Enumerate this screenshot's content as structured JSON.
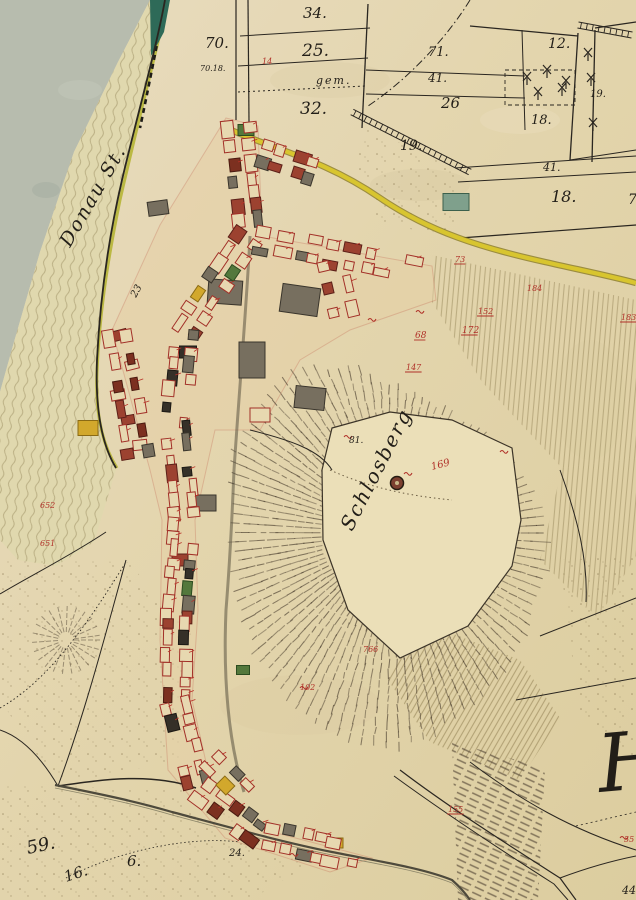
{
  "meta": {
    "map_type": "historical cadastral map",
    "sheet_letter": "H"
  },
  "palette": {
    "paper": "#e3d5ad",
    "paper_light": "#eaddc0",
    "paper_dark": "#d8c99e",
    "water": "#b7bcae",
    "flow_line": "#b3a77c",
    "shore": "#b6b536",
    "teal_bank": "#2e6a58",
    "road_yellow": "#d8c52f",
    "road_edge": "#8a7a26",
    "ink": "#2a2620",
    "carmine": "#a83028",
    "red_label": "#b03028",
    "hachure": "#44382a",
    "stone": "#776f5f",
    "stripe": "#b2a276",
    "village_tint": "#e5d0a6"
  },
  "labels": {
    "black": [
      {
        "t": "70.",
        "x": 205,
        "y": 48,
        "s": 15
      },
      {
        "t": "70.18.",
        "x": 200,
        "y": 71,
        "s": 8
      },
      {
        "t": "34.",
        "x": 303,
        "y": 18,
        "s": 15
      },
      {
        "t": "25.",
        "x": 302,
        "y": 56,
        "s": 17
      },
      {
        "t": "32.",
        "x": 300,
        "y": 114,
        "s": 17
      },
      {
        "t": "71.",
        "x": 428,
        "y": 56,
        "s": 13
      },
      {
        "t": "41.",
        "x": 428,
        "y": 82,
        "s": 12
      },
      {
        "t": "26",
        "x": 441,
        "y": 108,
        "s": 15
      },
      {
        "t": "12.",
        "x": 548,
        "y": 48,
        "s": 14
      },
      {
        "t": "19.",
        "x": 590,
        "y": 97,
        "s": 10
      },
      {
        "t": "18.",
        "x": 531,
        "y": 124,
        "s": 13
      },
      {
        "t": "41.",
        "x": 543,
        "y": 171,
        "s": 11
      },
      {
        "t": "18.",
        "x": 551,
        "y": 202,
        "s": 16
      },
      {
        "t": "70",
        "x": 628,
        "y": 204,
        "s": 14
      },
      {
        "t": "19.",
        "x": 400,
        "y": 150,
        "s": 14
      },
      {
        "t": "23",
        "x": 136,
        "y": 298,
        "s": 10,
        "r": -62
      },
      {
        "t": "81.",
        "x": 349,
        "y": 443,
        "s": 9
      },
      {
        "t": "24.",
        "x": 229,
        "y": 856,
        "s": 10
      },
      {
        "t": "59.",
        "x": 28,
        "y": 854,
        "s": 18,
        "r": -12
      },
      {
        "t": "16.",
        "x": 66,
        "y": 882,
        "s": 15,
        "r": -18
      },
      {
        "t": "6.",
        "x": 127,
        "y": 866,
        "s": 15
      },
      {
        "t": "44.",
        "x": 622,
        "y": 894,
        "s": 11
      }
    ],
    "script": [
      {
        "t": "gem.",
        "x": 316,
        "y": 84,
        "s": 11
      },
      {
        "t": "Donau St.",
        "x": 70,
        "y": 248,
        "s": 19,
        "r": -60
      },
      {
        "t": "Schlosberg",
        "x": 352,
        "y": 532,
        "s": 20,
        "r": -63
      },
      {
        "t": "H",
        "x": 600,
        "y": 792,
        "s": 80,
        "r": -5
      }
    ],
    "red": [
      {
        "t": "169",
        "x": 432,
        "y": 470,
        "s": 10,
        "r": -15
      },
      {
        "t": "68",
        "x": 415,
        "y": 338,
        "s": 9,
        "u": 1
      },
      {
        "t": "172",
        "x": 462,
        "y": 333,
        "s": 9,
        "u": 1
      },
      {
        "t": "147",
        "x": 406,
        "y": 370,
        "s": 8,
        "u": 1
      },
      {
        "t": "73",
        "x": 455,
        "y": 262,
        "s": 8,
        "u": 1
      },
      {
        "t": "152",
        "x": 478,
        "y": 314,
        "s": 8,
        "u": 1
      },
      {
        "t": "184",
        "x": 527,
        "y": 291,
        "s": 8
      },
      {
        "t": "183",
        "x": 621,
        "y": 320,
        "s": 8,
        "u": 1
      },
      {
        "t": "652",
        "x": 40,
        "y": 508,
        "s": 8
      },
      {
        "t": "651",
        "x": 40,
        "y": 546,
        "s": 8
      },
      {
        "t": "155",
        "x": 448,
        "y": 812,
        "s": 8,
        "u": 1
      },
      {
        "t": "766",
        "x": 363,
        "y": 652,
        "s": 8
      },
      {
        "t": "55",
        "x": 624,
        "y": 842,
        "s": 8
      },
      {
        "t": "102",
        "x": 300,
        "y": 690,
        "s": 8
      },
      {
        "t": "14",
        "x": 262,
        "y": 64,
        "s": 8
      }
    ]
  },
  "trees": [
    [
      527,
      77
    ],
    [
      547,
      70
    ],
    [
      566,
      81
    ],
    [
      538,
      92
    ],
    [
      562,
      88
    ],
    [
      588,
      53
    ],
    [
      591,
      78
    ],
    [
      593,
      123
    ]
  ],
  "geo": {
    "water": [
      [
        0,
        0
      ],
      [
        150,
        0
      ],
      [
        118,
        62
      ],
      [
        74,
        152
      ],
      [
        40,
        252
      ],
      [
        14,
        342
      ],
      [
        0,
        392
      ]
    ],
    "band": [
      [
        150,
        0
      ],
      [
        170,
        0
      ],
      [
        146,
        82
      ],
      [
        124,
        172
      ],
      [
        106,
        262
      ],
      [
        98,
        352
      ],
      [
        100,
        432
      ],
      [
        116,
        470
      ],
      [
        94,
        542
      ],
      [
        56,
        566
      ],
      [
        18,
        560
      ],
      [
        0,
        540
      ],
      [
        0,
        392
      ],
      [
        14,
        342
      ],
      [
        40,
        252
      ],
      [
        74,
        152
      ],
      [
        118,
        62
      ]
    ],
    "teal": [
      [
        150,
        0
      ],
      [
        170,
        0
      ],
      [
        164,
        32
      ],
      [
        151,
        56
      ]
    ],
    "shore": "M168,0 C156,52 136,130 120,200 C106,268 99,320 97,372 C95,415 103,446 117,468",
    "bank_ticks": "M165,2 C158,40 148,90 140,128",
    "village_tint": "M226,118 L258,126 L262,236 L432,266 L436,300 L350,330 L300,360 L260,430 L215,430 L195,520 L198,610 L192,700 L210,780 L265,830 L372,858 L330,872 L225,838 L168,770 L160,640 L162,520 L150,470 L112,330 L160,225 Z",
    "plateau": "M332,428 L390,412 L452,420 L512,448 L521,520 L512,566 L468,626 L400,658 L348,610 L323,540 L322,470 Z",
    "plateau_rows": "M330,470 C370,488 410,496 452,500",
    "hill": {
      "cx": 393,
      "cy": 533,
      "min": 70,
      "max": [
        152,
        160,
        185,
        215,
        200,
        172,
        158,
        182,
        192,
        150,
        128,
        142
      ]
    },
    "knob": {
      "cx": 66,
      "cy": 640,
      "rmin": 8,
      "rmax": 32
    },
    "hach_bands": [
      [
        [
          452,
          742
        ],
        [
          545,
          768
        ],
        [
          538,
          900
        ],
        [
          458,
          900
        ]
      ]
    ],
    "stripesA": [
      [
        [
          432,
          255
        ],
        [
          636,
          300
        ],
        [
          636,
          458
        ],
        [
          562,
          468
        ],
        [
          482,
          382
        ],
        [
          432,
          302
        ]
      ],
      [
        [
          562,
          468
        ],
        [
          636,
          458
        ],
        [
          636,
          556
        ],
        [
          598,
          618
        ],
        [
          540,
          560
        ]
      ]
    ],
    "stripesB": [
      [
        [
          418,
          620
        ],
        [
          520,
          660
        ],
        [
          560,
          718
        ],
        [
          520,
          780
        ],
        [
          430,
          742
        ],
        [
          388,
          680
        ]
      ]
    ],
    "stipple": [
      [
        [
          0,
          560
        ],
        [
          128,
          562
        ],
        [
          196,
          640
        ],
        [
          178,
          760
        ],
        [
          58,
          786
        ],
        [
          0,
          700
        ]
      ],
      [
        [
          0,
          786
        ],
        [
          58,
          786
        ],
        [
          196,
          790
        ],
        [
          320,
          858
        ],
        [
          250,
          900
        ],
        [
          0,
          900
        ]
      ],
      [
        [
          368,
          128
        ],
        [
          460,
          170
        ],
        [
          455,
          235
        ],
        [
          380,
          225
        ],
        [
          352,
          160
        ]
      ],
      [
        [
          560,
          560
        ],
        [
          636,
          556
        ],
        [
          636,
          760
        ],
        [
          580,
          720
        ]
      ]
    ],
    "road_main": "M222,126 C268,148 322,158 380,198 C430,232 482,248 545,262 C580,270 610,276 636,283",
    "stream": "M55,785 C95,793 135,801 172,812 C232,828 282,842 332,852 C382,862 422,868 452,880 C460,887 466,894 470,900",
    "lane": "M250,236 C247,300 240,380 234,470 C232,520 230,560 226,610 C223,680 228,740 244,792",
    "ladders": [
      [
        352,
        112,
        470,
        172
      ],
      [
        578,
        25,
        632,
        35
      ]
    ],
    "boundaries": [
      {
        "d": "M236,0 L236,120",
        "w": 1.2
      },
      {
        "d": "M248,0 L249,122",
        "w": 1.2
      },
      {
        "d": "M165,0 C156,50 136,120 122,180 C108,240 100,300 97,360 C95,410 102,445 116,468",
        "w": 1.8
      },
      {
        "d": "M240,36 L370,28",
        "w": 1
      },
      {
        "d": "M238,66 L368,58",
        "w": 1
      },
      {
        "d": "M238,92 L366,86",
        "w": 1,
        "da": "2 3"
      },
      {
        "d": "M368,4 L362,128",
        "w": 1.3
      },
      {
        "d": "M366,70 L525,76",
        "w": 1
      },
      {
        "d": "M366,94 L525,98",
        "w": 1
      },
      {
        "d": "M522,30 L525,130",
        "w": 1
      },
      {
        "d": "M470,26 L578,36",
        "w": 1.2
      },
      {
        "d": "M578,33 L570,160",
        "w": 1.3
      },
      {
        "d": "M595,30 L592,162",
        "w": 1.3
      },
      {
        "d": "M595,28 L636,22",
        "w": 1.2
      },
      {
        "d": "M570,160 L636,150",
        "w": 1
      },
      {
        "d": "M455,168 L636,156",
        "w": 1
      },
      {
        "d": "M458,182 L636,172",
        "w": 1
      },
      {
        "d": "M460,238 L636,225",
        "w": 1.2
      },
      {
        "d": "M470,0 C448,36 410,78 368,106",
        "w": 1,
        "da": "8 3 1.5 3"
      },
      {
        "d": "M106,532 C70,556 30,576 0,594",
        "w": 1
      },
      {
        "d": "M126,560 C104,640 84,716 58,786",
        "w": 1
      },
      {
        "d": "M58,786 C38,752 18,736 0,730",
        "w": 1
      },
      {
        "d": "M196,788 C150,772 100,780 58,786",
        "w": 1.5
      },
      {
        "d": "M0,708 C50,680 90,620 126,562",
        "w": 0.9,
        "da": "1.5 2.5"
      },
      {
        "d": "M66,878 C120,850 190,836 240,842",
        "w": 0.8,
        "da": "1.5 2.5"
      },
      {
        "d": "M540,636 L636,598",
        "w": 1
      },
      {
        "d": "M516,700 L636,678",
        "w": 1
      },
      {
        "d": "M470,762 C520,800 572,830 636,850",
        "w": 1
      },
      {
        "d": "M400,770 C450,808 510,846 560,878 L576,900",
        "w": 1.2
      },
      {
        "d": "M394,776 C446,814 504,852 554,884 L568,900",
        "w": 1
      },
      {
        "d": "M560,878 C592,866 616,860 636,856",
        "w": 1
      },
      {
        "d": "M576,826 L636,812",
        "w": 0.8,
        "da": "2 3"
      },
      {
        "d": "M560,470 C578,520 588,560 586,602",
        "w": 1
      },
      {
        "d": "M250,430 C290,440 320,450 332,470",
        "w": 1
      },
      {
        "d": "M505,70 L575,70 L575,105 L505,105 Z",
        "w": 0.9,
        "da": "4 3"
      }
    ],
    "tower": {
      "cx": 397,
      "cy": 483,
      "r": 6.5
    }
  },
  "village": {
    "streets": [
      [
        238,
        122,
        250,
        232,
        7
      ],
      [
        250,
        232,
        184,
        330,
        7
      ],
      [
        184,
        330,
        175,
        425,
        7
      ],
      [
        175,
        425,
        185,
        518,
        7
      ],
      [
        185,
        518,
        177,
        608,
        7
      ],
      [
        177,
        608,
        175,
        698,
        7
      ],
      [
        175,
        698,
        197,
        788,
        6
      ],
      [
        197,
        788,
        262,
        836,
        5
      ],
      [
        262,
        836,
        360,
        856,
        6
      ],
      [
        258,
        240,
        344,
        256,
        5
      ],
      [
        344,
        256,
        424,
        272,
        5
      ],
      [
        256,
        152,
        320,
        172,
        4
      ],
      [
        118,
        332,
        140,
        462,
        6
      ],
      [
        332,
        258,
        346,
        318,
        3
      ],
      [
        210,
        760,
        250,
        800,
        3
      ]
    ],
    "buildings": [
      [
        225,
        292,
        34,
        24,
        4,
        "stone"
      ],
      [
        300,
        300,
        38,
        28,
        8,
        "stone"
      ],
      [
        252,
        360,
        26,
        36,
        0,
        "stone"
      ],
      [
        188,
        352,
        17,
        12,
        0,
        "dark"
      ],
      [
        88,
        428,
        20,
        15,
        0,
        "yellow"
      ],
      [
        246,
        130,
        16,
        11,
        0,
        "green"
      ],
      [
        456,
        202,
        26,
        17,
        0,
        "teal"
      ],
      [
        336,
        843,
        14,
        10,
        0,
        "yellow"
      ],
      [
        204,
        503,
        24,
        16,
        0,
        "stone"
      ],
      [
        158,
        208,
        20,
        14,
        -8,
        "stone"
      ],
      [
        243,
        670,
        13,
        9,
        0,
        "green"
      ],
      [
        180,
        560,
        16,
        12,
        0,
        "carmine"
      ],
      [
        310,
        398,
        30,
        22,
        6,
        "stone"
      ],
      [
        260,
        415,
        20,
        14,
        0,
        "outline"
      ],
      [
        120,
        335,
        14,
        10,
        -14,
        "carmine"
      ],
      [
        132,
        365,
        13,
        9,
        -14,
        "outline"
      ],
      [
        118,
        395,
        14,
        10,
        -10,
        "outline"
      ],
      [
        128,
        420,
        13,
        9,
        -10,
        "carmine"
      ],
      [
        140,
        445,
        14,
        10,
        -6,
        "outline"
      ]
    ],
    "red_marks": [
      [
        344,
        437
      ],
      [
        500,
        452
      ],
      [
        368,
        320
      ],
      [
        416,
        312
      ],
      [
        404,
        474
      ],
      [
        290,
        855
      ],
      [
        300,
        688
      ],
      [
        620,
        838
      ]
    ]
  }
}
